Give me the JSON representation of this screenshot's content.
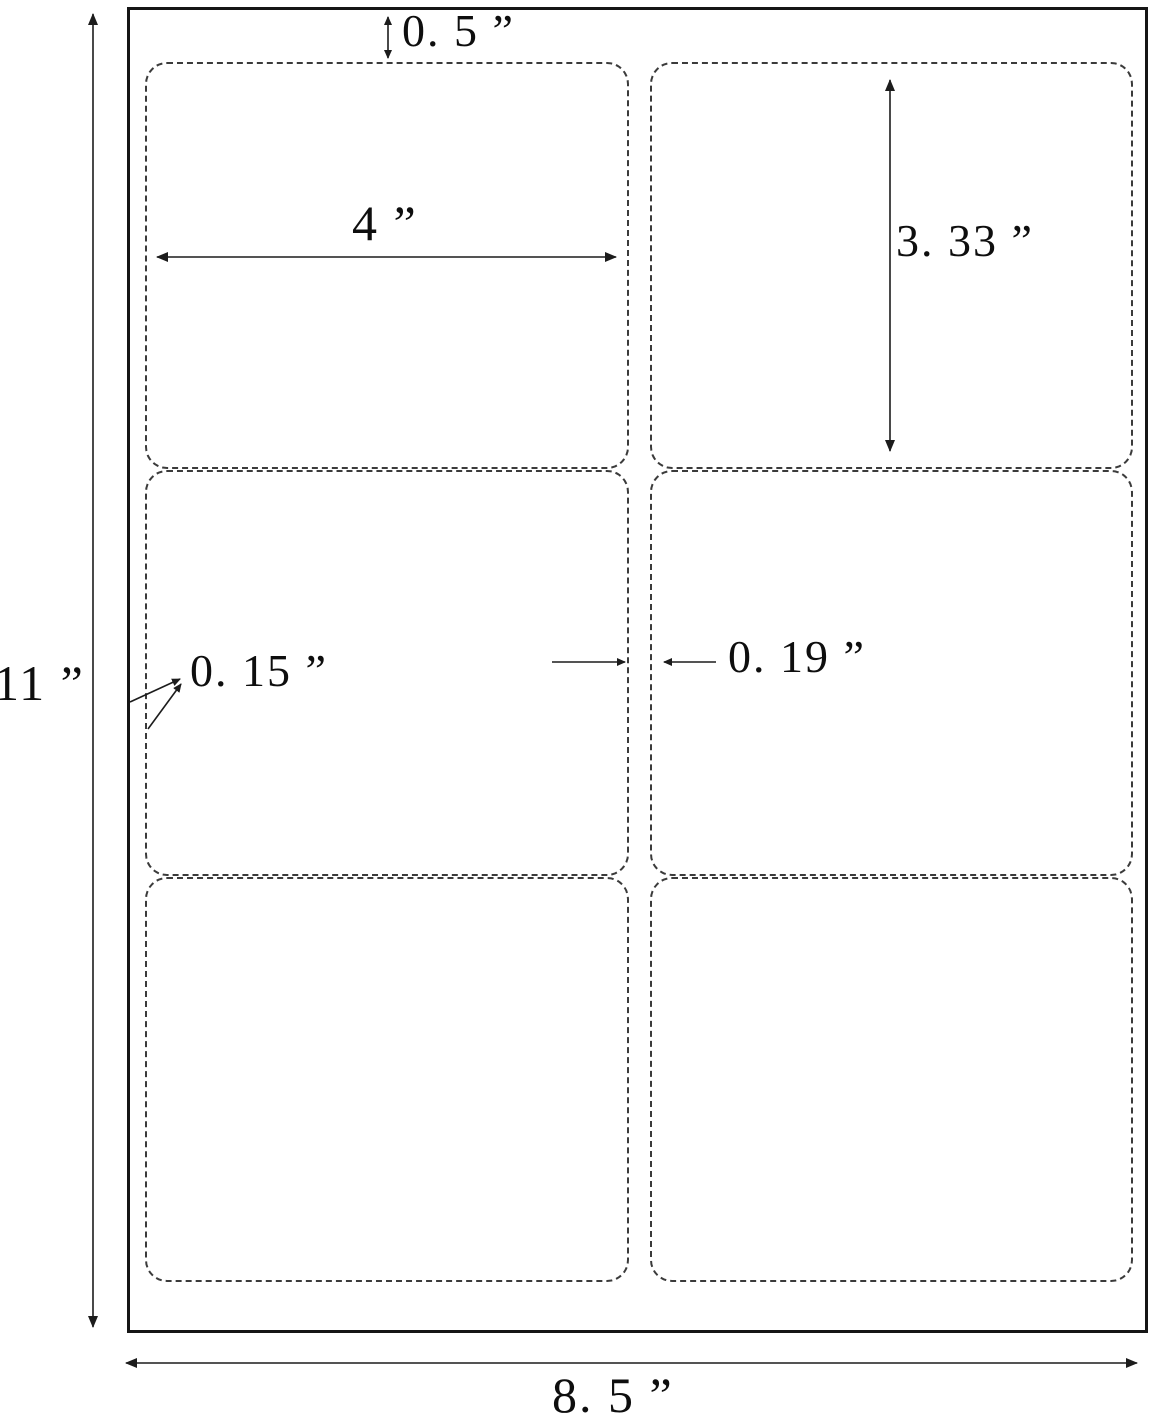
{
  "diagram": {
    "type": "label-sheet-dimension-diagram",
    "sheet": {
      "rows": 3,
      "columns": 2,
      "labels_count": 6
    },
    "dimensions": {
      "page_height": "11 ”",
      "page_width": "8. 5 ”",
      "top_margin": "0. 5 ”",
      "label_width": "4 ”",
      "label_height": "3. 33 ”",
      "side_margin": "0. 15 ”",
      "column_gap": "0. 19 ”"
    },
    "colors": {
      "background": "#ffffff",
      "page_border": "#161616",
      "label_border": "#3b3b3b",
      "dimension_line": "#1c1c1c",
      "text": "#0e0e0e"
    }
  }
}
